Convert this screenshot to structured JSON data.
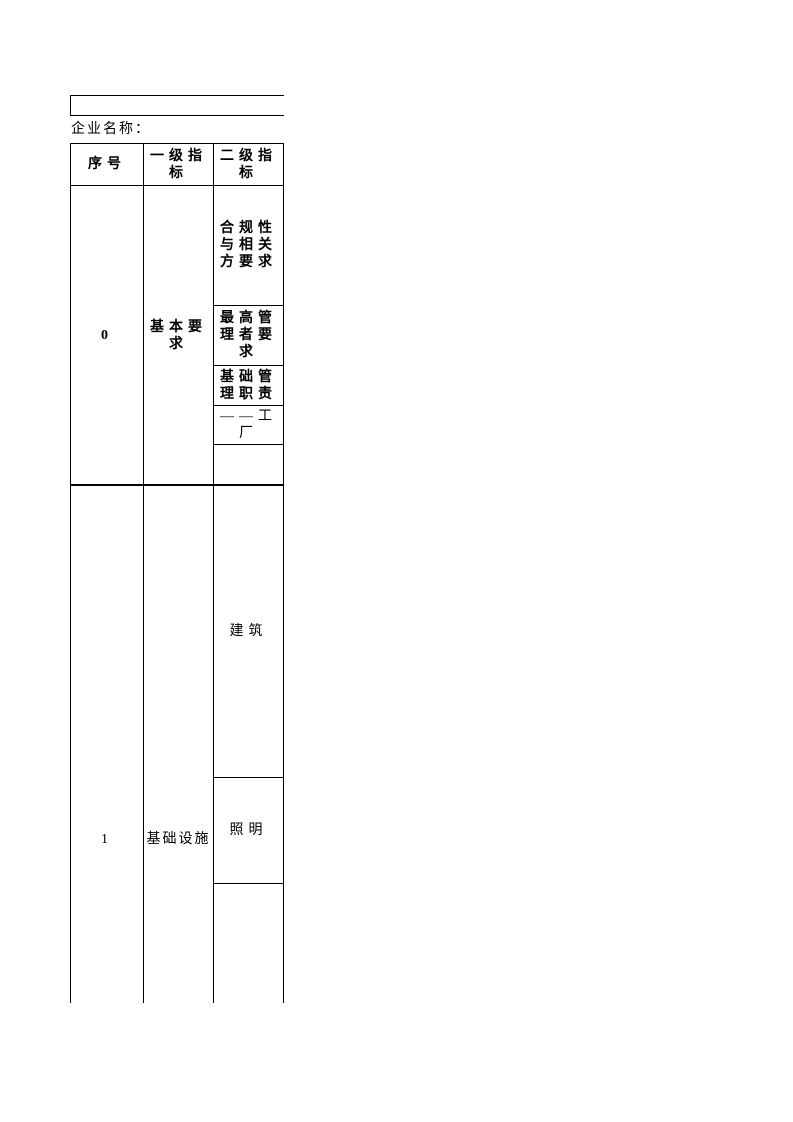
{
  "form": {
    "company_label": "企业名称："
  },
  "table": {
    "headers": [
      "序号",
      "一级指\n标",
      "二级指\n标"
    ],
    "rows": [
      {
        "no": "0",
        "level1": "基本要\n求",
        "level2": [
          "合规性\n与相关\n方要求",
          "最高管\n理者要\n求",
          "基础管\n理职责",
          "——工\n厂",
          ""
        ]
      },
      {
        "no": "1",
        "level1": "基础设施",
        "level2": [
          "建筑",
          "照明",
          ""
        ]
      }
    ]
  }
}
